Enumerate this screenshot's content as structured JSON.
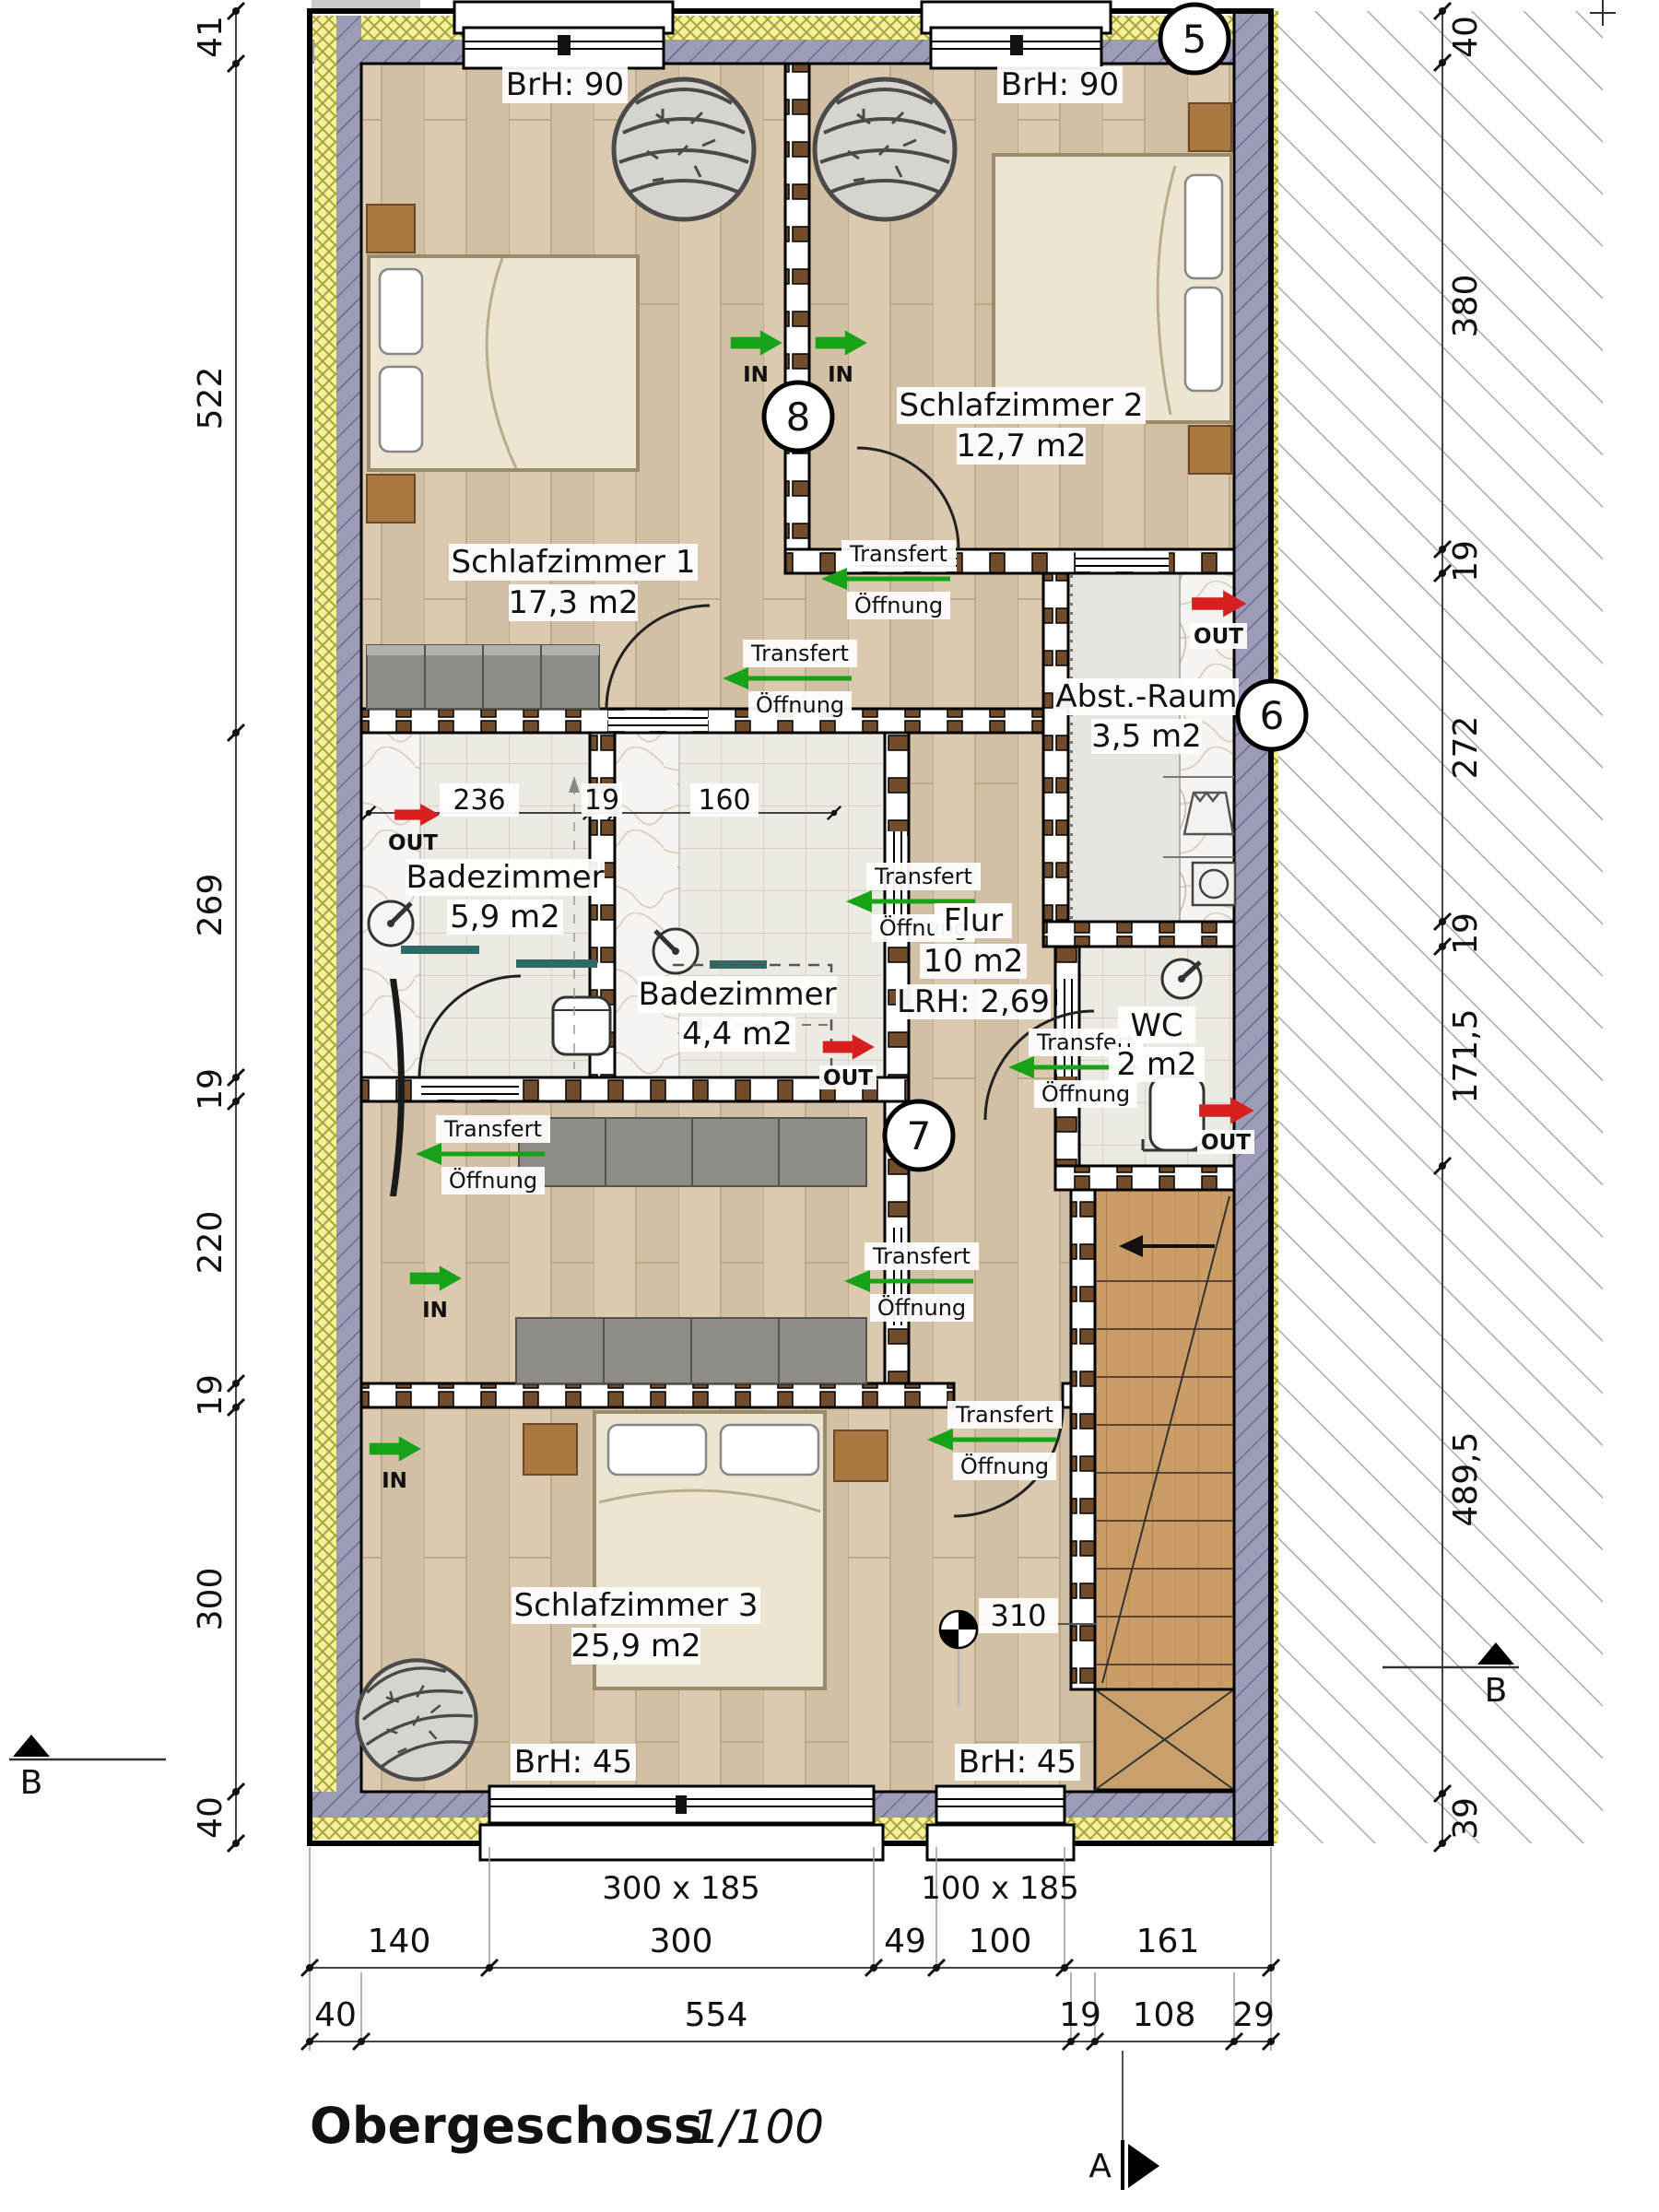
{
  "title": {
    "name": "Obergeschoss",
    "scale": "1/100"
  },
  "rooms": {
    "sz1": {
      "name": "Schlafzimmer 1",
      "area": "17,3 m2"
    },
    "sz2": {
      "name": "Schlafzimmer 2",
      "area": "12,7 m2"
    },
    "sz3": {
      "name": "Schlafzimmer 3",
      "area": "25,9 m2"
    },
    "bad1": {
      "name": "Badezimmer",
      "area": "5,9 m2"
    },
    "bad2": {
      "name": "Badezimmer",
      "area": "4,4 m2"
    },
    "abst": {
      "name": "Abst.-Raum",
      "area": "3,5 m2"
    },
    "flur": {
      "name": "Flur",
      "area": "10 m2",
      "lrh": "LRH: 2,69"
    },
    "wc": {
      "name": "WC",
      "area": "2 m2"
    }
  },
  "labels": {
    "brh90": "BrH: 90",
    "brh45": "BrH: 45",
    "win300": "300 x 185",
    "win100": "100 x 185",
    "point310": "310"
  },
  "annotations": {
    "transfert": "Transfert",
    "oeffnung": "Öffnung",
    "in": "IN",
    "out": "OUT"
  },
  "markers": {
    "c5": "5",
    "c6": "6",
    "c7": "7",
    "c8": "8",
    "sectionA": "A",
    "sectionB": "B"
  },
  "dimensions": {
    "left": [
      "41",
      "522",
      "269",
      "19",
      "220",
      "19",
      "300",
      "40"
    ],
    "right": [
      "40",
      "380",
      "19",
      "272",
      "19",
      "171,5",
      "489,5",
      "39"
    ],
    "bottom_outer": [
      "140",
      "300",
      "49",
      "100",
      "161"
    ],
    "bottom_inner": [
      "40",
      "554",
      "19",
      "108",
      "29"
    ],
    "bath": [
      "236",
      "19",
      "160"
    ]
  },
  "colors": {
    "wood": "#d8c6ac",
    "masonry_wall": "#9c9cb8",
    "insulation": "#f4f09c",
    "stud_bar": "#734d2b",
    "green": "#17a317",
    "red": "#d81f1f",
    "tile": "#eceae3",
    "stair_wood": "#cb9d66",
    "furniture_gray": "#8f8d88"
  }
}
